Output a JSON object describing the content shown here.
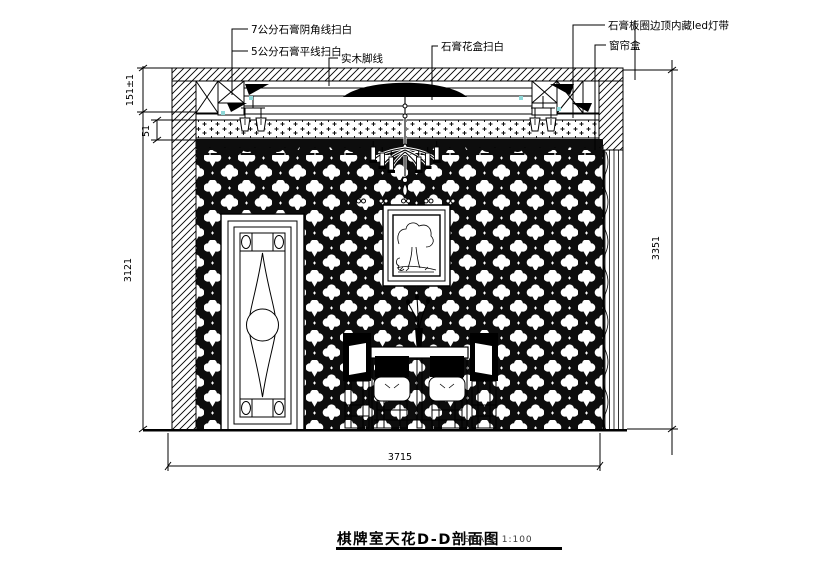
{
  "drawing": {
    "annotations": {
      "corner_line": "7公分石膏阴角线扫白",
      "flat_line": "5公分石膏平线扫白",
      "wood_line": "实木脚线",
      "flower_box": "石膏花盒扫白",
      "led_strip": "石膏板圈边顶内藏led灯带",
      "curtain_box": "窗帘盒"
    },
    "dimensions": {
      "left_top": "151±1",
      "left_mid": "51",
      "left_height": "3121",
      "right_height": "3351",
      "bottom_width": "3715"
    },
    "title": {
      "text": "棋牌室天花D-D剖面图",
      "scale_label": "SCALE 1:100"
    },
    "colors": {
      "line": "#000000",
      "background": "#ffffff",
      "marker": "#8fd8d8"
    }
  }
}
